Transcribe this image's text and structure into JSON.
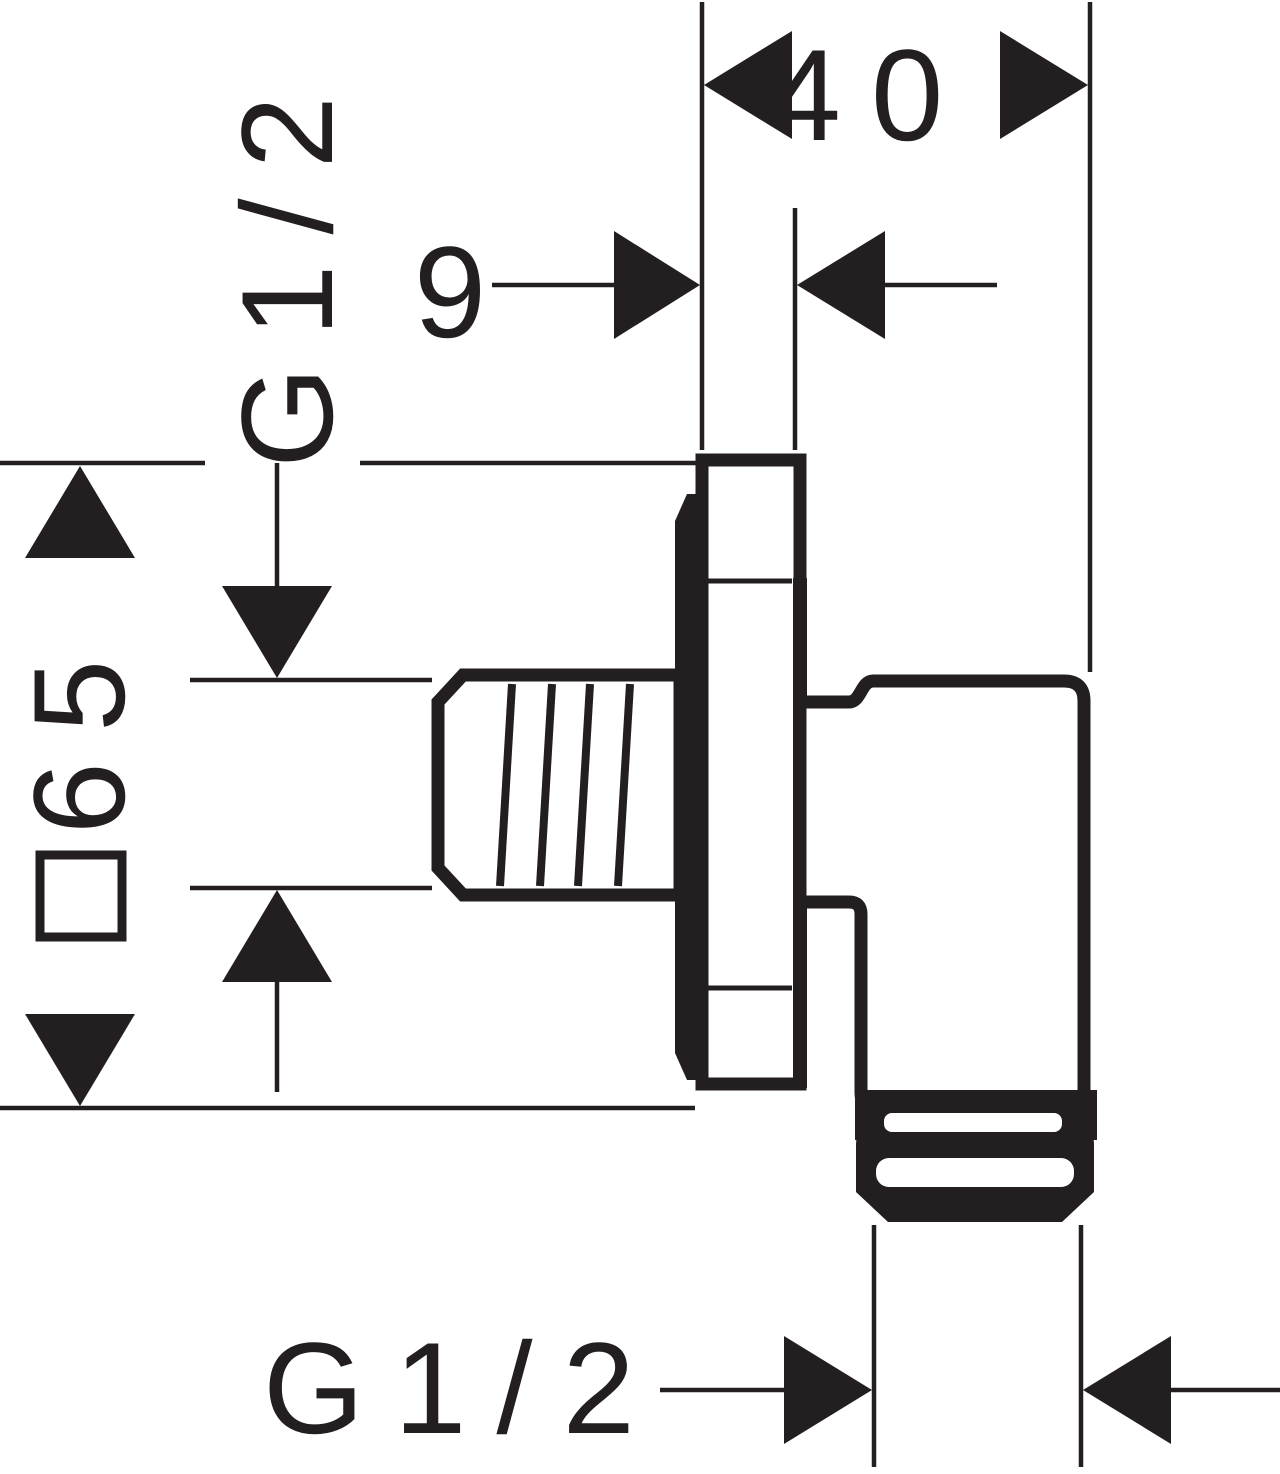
{
  "page": {
    "background": "#ffffff",
    "ink_color": "#231f20",
    "kind": "technical dimension drawing, side elevation of a wall outlet fitting"
  },
  "dimensions": {
    "depth_total": "40",
    "plate_thickness": "9",
    "thread_top": "G1/2",
    "square_symbol": "□",
    "square_size": "65",
    "thread_bottom": "G1/2"
  }
}
